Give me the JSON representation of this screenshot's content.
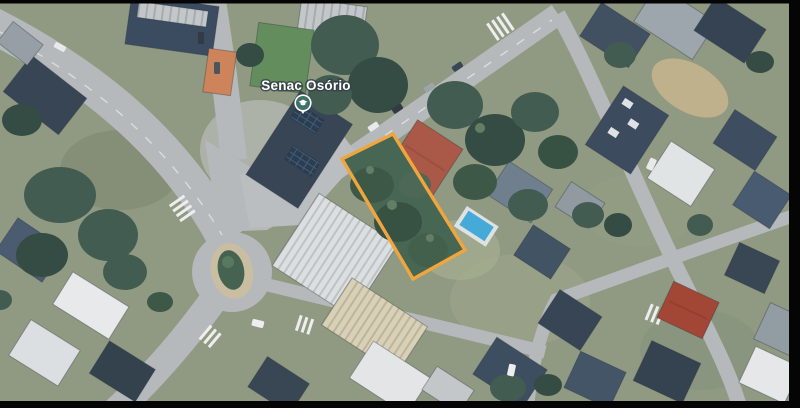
{
  "map": {
    "place": {
      "label": "Senac Osório",
      "pin_icon": "education-pin"
    },
    "lot_overlay": {
      "points": "342,159 393,134 465,250 413,279"
    }
  },
  "colors": {
    "frame": "#000000",
    "accent": "#F0A63C",
    "label_text": "#FFFFFF",
    "pin_fill": "#3E7168",
    "pool": "#3FA8D9",
    "road": "#B4B8BA",
    "terrain": "#8D977E",
    "trees": "#3A564A",
    "roof_dark": "#2F3E4E",
    "roof_red": "#A34E36",
    "roof_white": "#E8EAEB",
    "island_tan": "#C9BDA0"
  }
}
